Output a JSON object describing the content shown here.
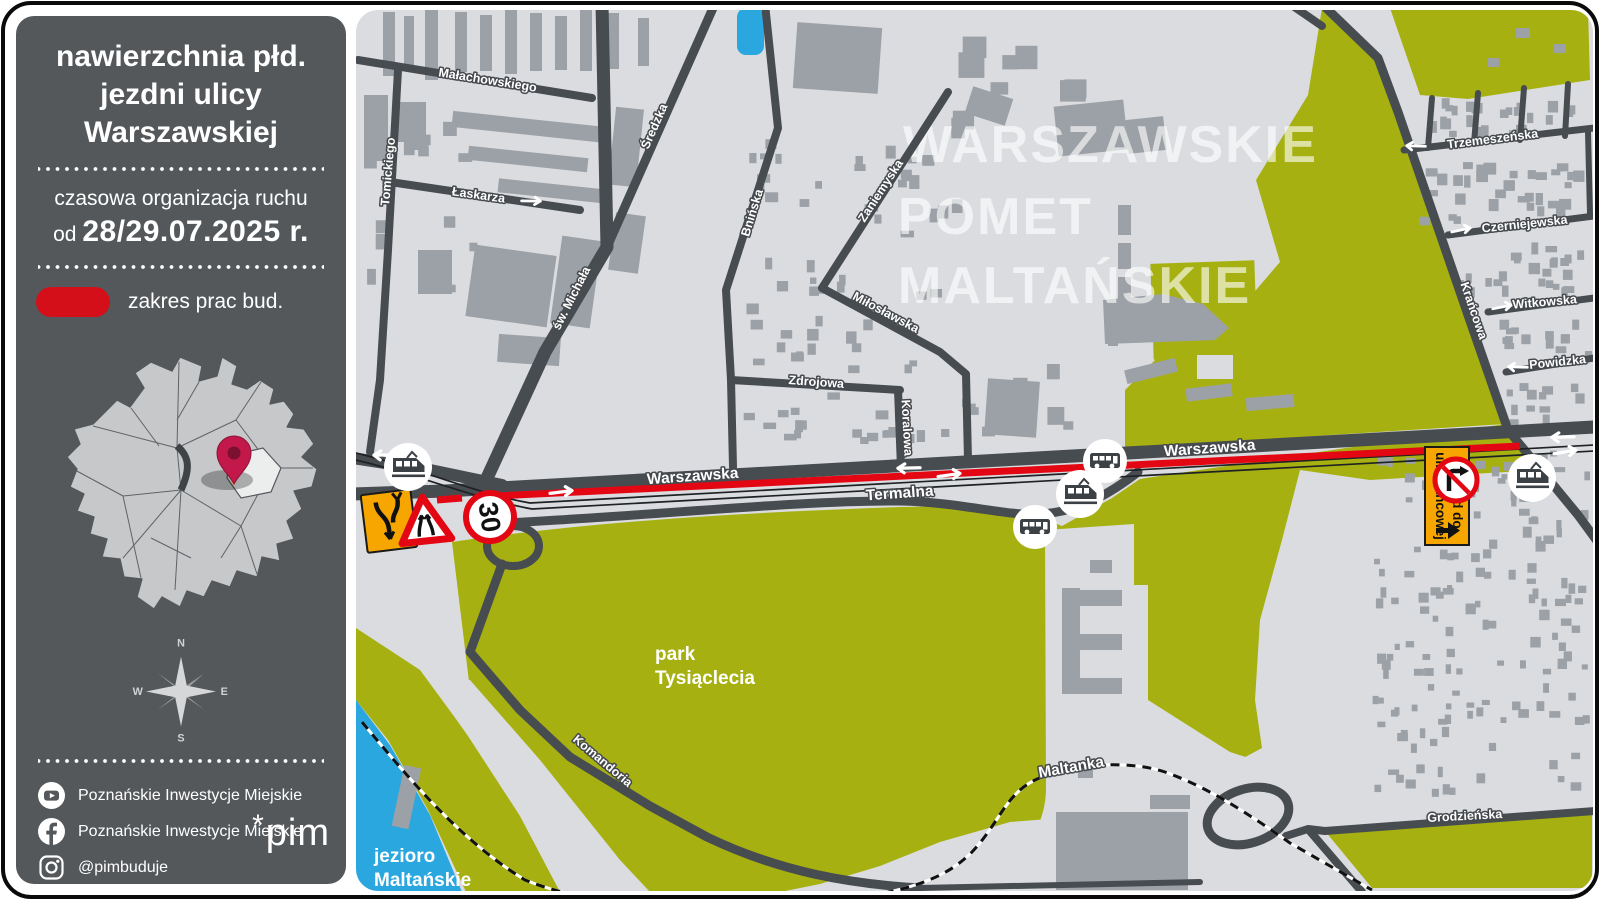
{
  "sidebar": {
    "title_lines": [
      "nawierzchnia płd.",
      "jezdni ulicy",
      "Warszawskiej"
    ],
    "subtitle": "czasowa organizacja ruchu",
    "date_prefix": "od",
    "date": "28/29.07.2025 r.",
    "legend": {
      "label": "zakres prac bud."
    },
    "compass": {
      "n": "N",
      "e": "E",
      "s": "S",
      "w": "W"
    },
    "social": [
      {
        "icon": "youtube-icon",
        "label": "Poznańskie Inwestycje Miejskie"
      },
      {
        "icon": "facebook-icon",
        "label": "Poznańskie Inwestycje Miejskie"
      },
      {
        "icon": "instagram-icon",
        "label": "@pimbuduje"
      }
    ],
    "logo_asterisk": "*",
    "logo_text": "pim"
  },
  "map": {
    "watermark": [
      "WARSZAWSKIE",
      "POMET",
      "MALTAŃSKIE"
    ],
    "streets": {
      "malachowskiego": "Małachowskiego",
      "tomickiego": "Tomickiego",
      "laskarza": "Łaskarza",
      "sw_michala": "św. Michała",
      "sredzka": "Średzka",
      "bninska": "Bnińska",
      "zaniemyska": "Zaniemyska",
      "miloslawska": "Miłosławska",
      "zdrojowa": "Zdrojowa",
      "koralowa": "Koralowa",
      "warszawska": "Warszawska",
      "termalna": "Termalna",
      "komandoria": "Komandoria",
      "krancowa": "Krańcowa",
      "trzemeszenska": "Trzemeszeńska",
      "czerniejewska": "Czerniejewska",
      "witkowska": "Witkowska",
      "powidzka": "Powidzka",
      "grodzienska": "Grodzieńska"
    },
    "areas": {
      "park_line1": "park",
      "park_line2": "Tysiąclecia",
      "lake_line1": "jezioro",
      "lake_line2": "Maltańskie",
      "railway": "Maltanka"
    },
    "signs": {
      "speed_limit": "30",
      "detour_line1": "Objazd do",
      "detour_line2": "ul. Krańcowej"
    },
    "transit_badges": [
      "tram",
      "bus",
      "tram",
      "bus",
      "tram"
    ],
    "colors": {
      "sidebar_bg": "#54585b",
      "map_bg": "#dbdcdf",
      "road_gray": "#474c51",
      "building_gray": "#9ba1a6",
      "park_green": "#a6b111",
      "water_blue": "#2ba7e0",
      "construction_red": "#e30613",
      "accent_red": "#d40f1a",
      "sign_yellow": "#f7a600"
    }
  }
}
